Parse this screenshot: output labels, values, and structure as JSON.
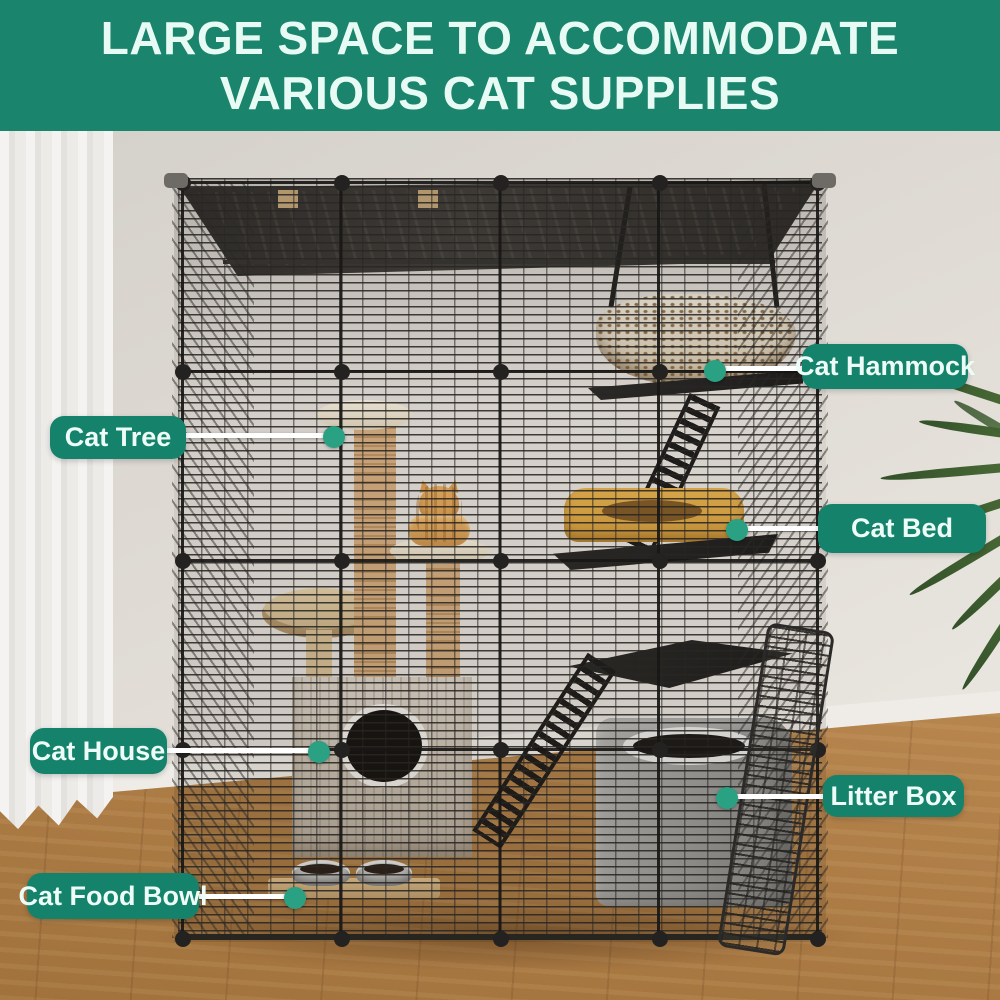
{
  "banner": {
    "title_line1": "LARGE SPACE TO ACCOMMODATE",
    "title_line2": "VARIOUS CAT SUPPLIES"
  },
  "callouts": [
    {
      "id": "cat-tree",
      "label": "Cat Tree"
    },
    {
      "id": "cat-hammock",
      "label": "Cat Hammock"
    },
    {
      "id": "cat-bed",
      "label": "Cat Bed"
    },
    {
      "id": "cat-house",
      "label": "Cat House"
    },
    {
      "id": "litter-box",
      "label": "Litter Box"
    },
    {
      "id": "cat-food-bowl",
      "label": "Cat Food Bowl"
    }
  ],
  "scene": {
    "description": "Black wire modular cat cage in a room with white curtain, wood floor and palm plant",
    "objects": [
      "cat-cage",
      "cat-hammock",
      "cat-bed",
      "cat-tree",
      "orange-tabby-cat",
      "cat-house",
      "litter-box",
      "cat-food-bowls",
      "ramp-ladders",
      "open-door",
      "curtain",
      "palm-plant",
      "wood-floor"
    ]
  },
  "colors": {
    "banner_green": "#1A846C",
    "label_green": "#15836C",
    "dot_green": "#2AA183",
    "banner_text": "#E7FBF4",
    "wall": "#DED9D3",
    "wood_floor": "#B5834C",
    "cage_wire": "#282623"
  }
}
